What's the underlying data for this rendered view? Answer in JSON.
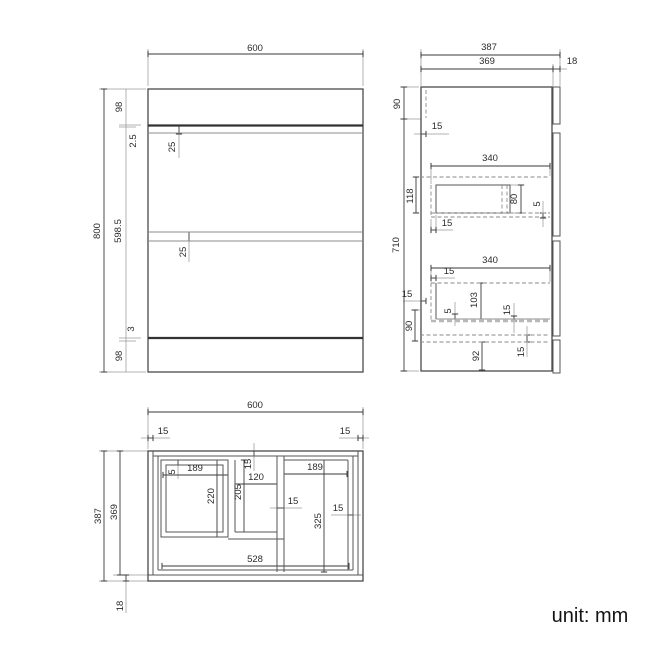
{
  "unit_label": "unit: mm",
  "colors": {
    "ink": "#3a3a3a",
    "text": "#2b2b2b"
  },
  "front_view": {
    "dims": {
      "width": "600",
      "height": "800",
      "top_section": "98",
      "top_gap": "2.5",
      "top_overlap": "25",
      "drawer_zone": "598.5",
      "drawer_gap": "25",
      "bottom_gap": "3",
      "plinth": "98"
    }
  },
  "side_view": {
    "dims": {
      "total_depth": "387",
      "carcass_depth": "369",
      "front_panel": "18",
      "top_zone": "90",
      "back_panel_top": "15",
      "drawer1_width": "340",
      "drawer1_zone": "118",
      "drawer1_side": "80",
      "drawer1_gap": "5",
      "drawer1_back": "15",
      "body_height": "710",
      "drawer2_width": "340",
      "drawer2_back": "15",
      "back_panel_low": "15",
      "drawer2_side": "103",
      "drawer2_gap": "5",
      "drawer2_inset": "15",
      "bottom_zone": "90",
      "bottom_panel": "15",
      "plinth": "92"
    }
  },
  "plan_view": {
    "dims": {
      "width": "600",
      "side_panel_left": "15",
      "side_panel_right": "15",
      "total_depth": "387",
      "carcass_depth": "369",
      "front_panel": "18",
      "left_gap": "5",
      "left_box_width": "189",
      "back_panel": "15",
      "opening_width": "120",
      "right_box_width": "189",
      "left_box_depth": "220",
      "opening_depth": "205",
      "opening_wall": "15",
      "right_box_depth": "325",
      "right_wall": "15",
      "inner_width": "528"
    }
  }
}
